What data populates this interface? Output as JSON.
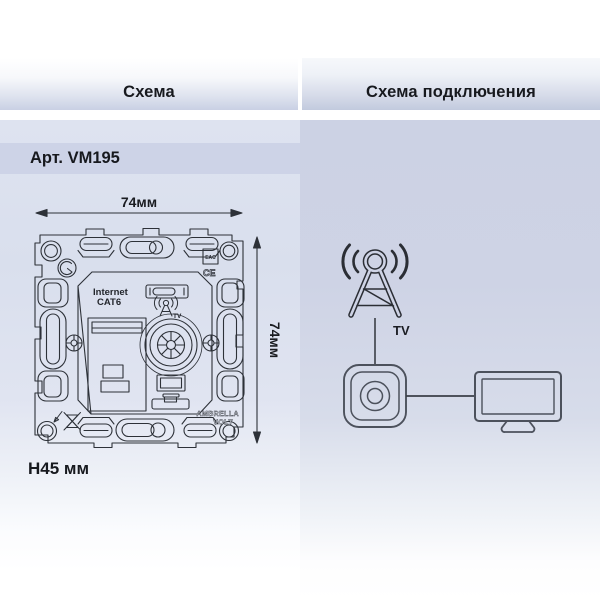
{
  "header": {
    "schema_tab": "Схема",
    "connection_tab": "Схема подключения"
  },
  "left_panel": {
    "article": "Арт. VM195",
    "dim_width": "74мм",
    "dim_height": "74мм",
    "mount_depth": "H45 мм",
    "mechanism": {
      "internet_label": "Internet",
      "cat_label": "CAT6",
      "tv_label": "TV",
      "brand_line1": "AMBRELLA",
      "brand_line2": "VOLT",
      "ce_mark": "CE",
      "eac_mark": "EAC"
    }
  },
  "right_panel": {
    "tv_label": "TV"
  },
  "colors": {
    "band": "#cdd3e7",
    "drawing_line": "#2d3138",
    "icon_stroke": "#4c515c",
    "antenna_stroke": "#2b2e35"
  }
}
